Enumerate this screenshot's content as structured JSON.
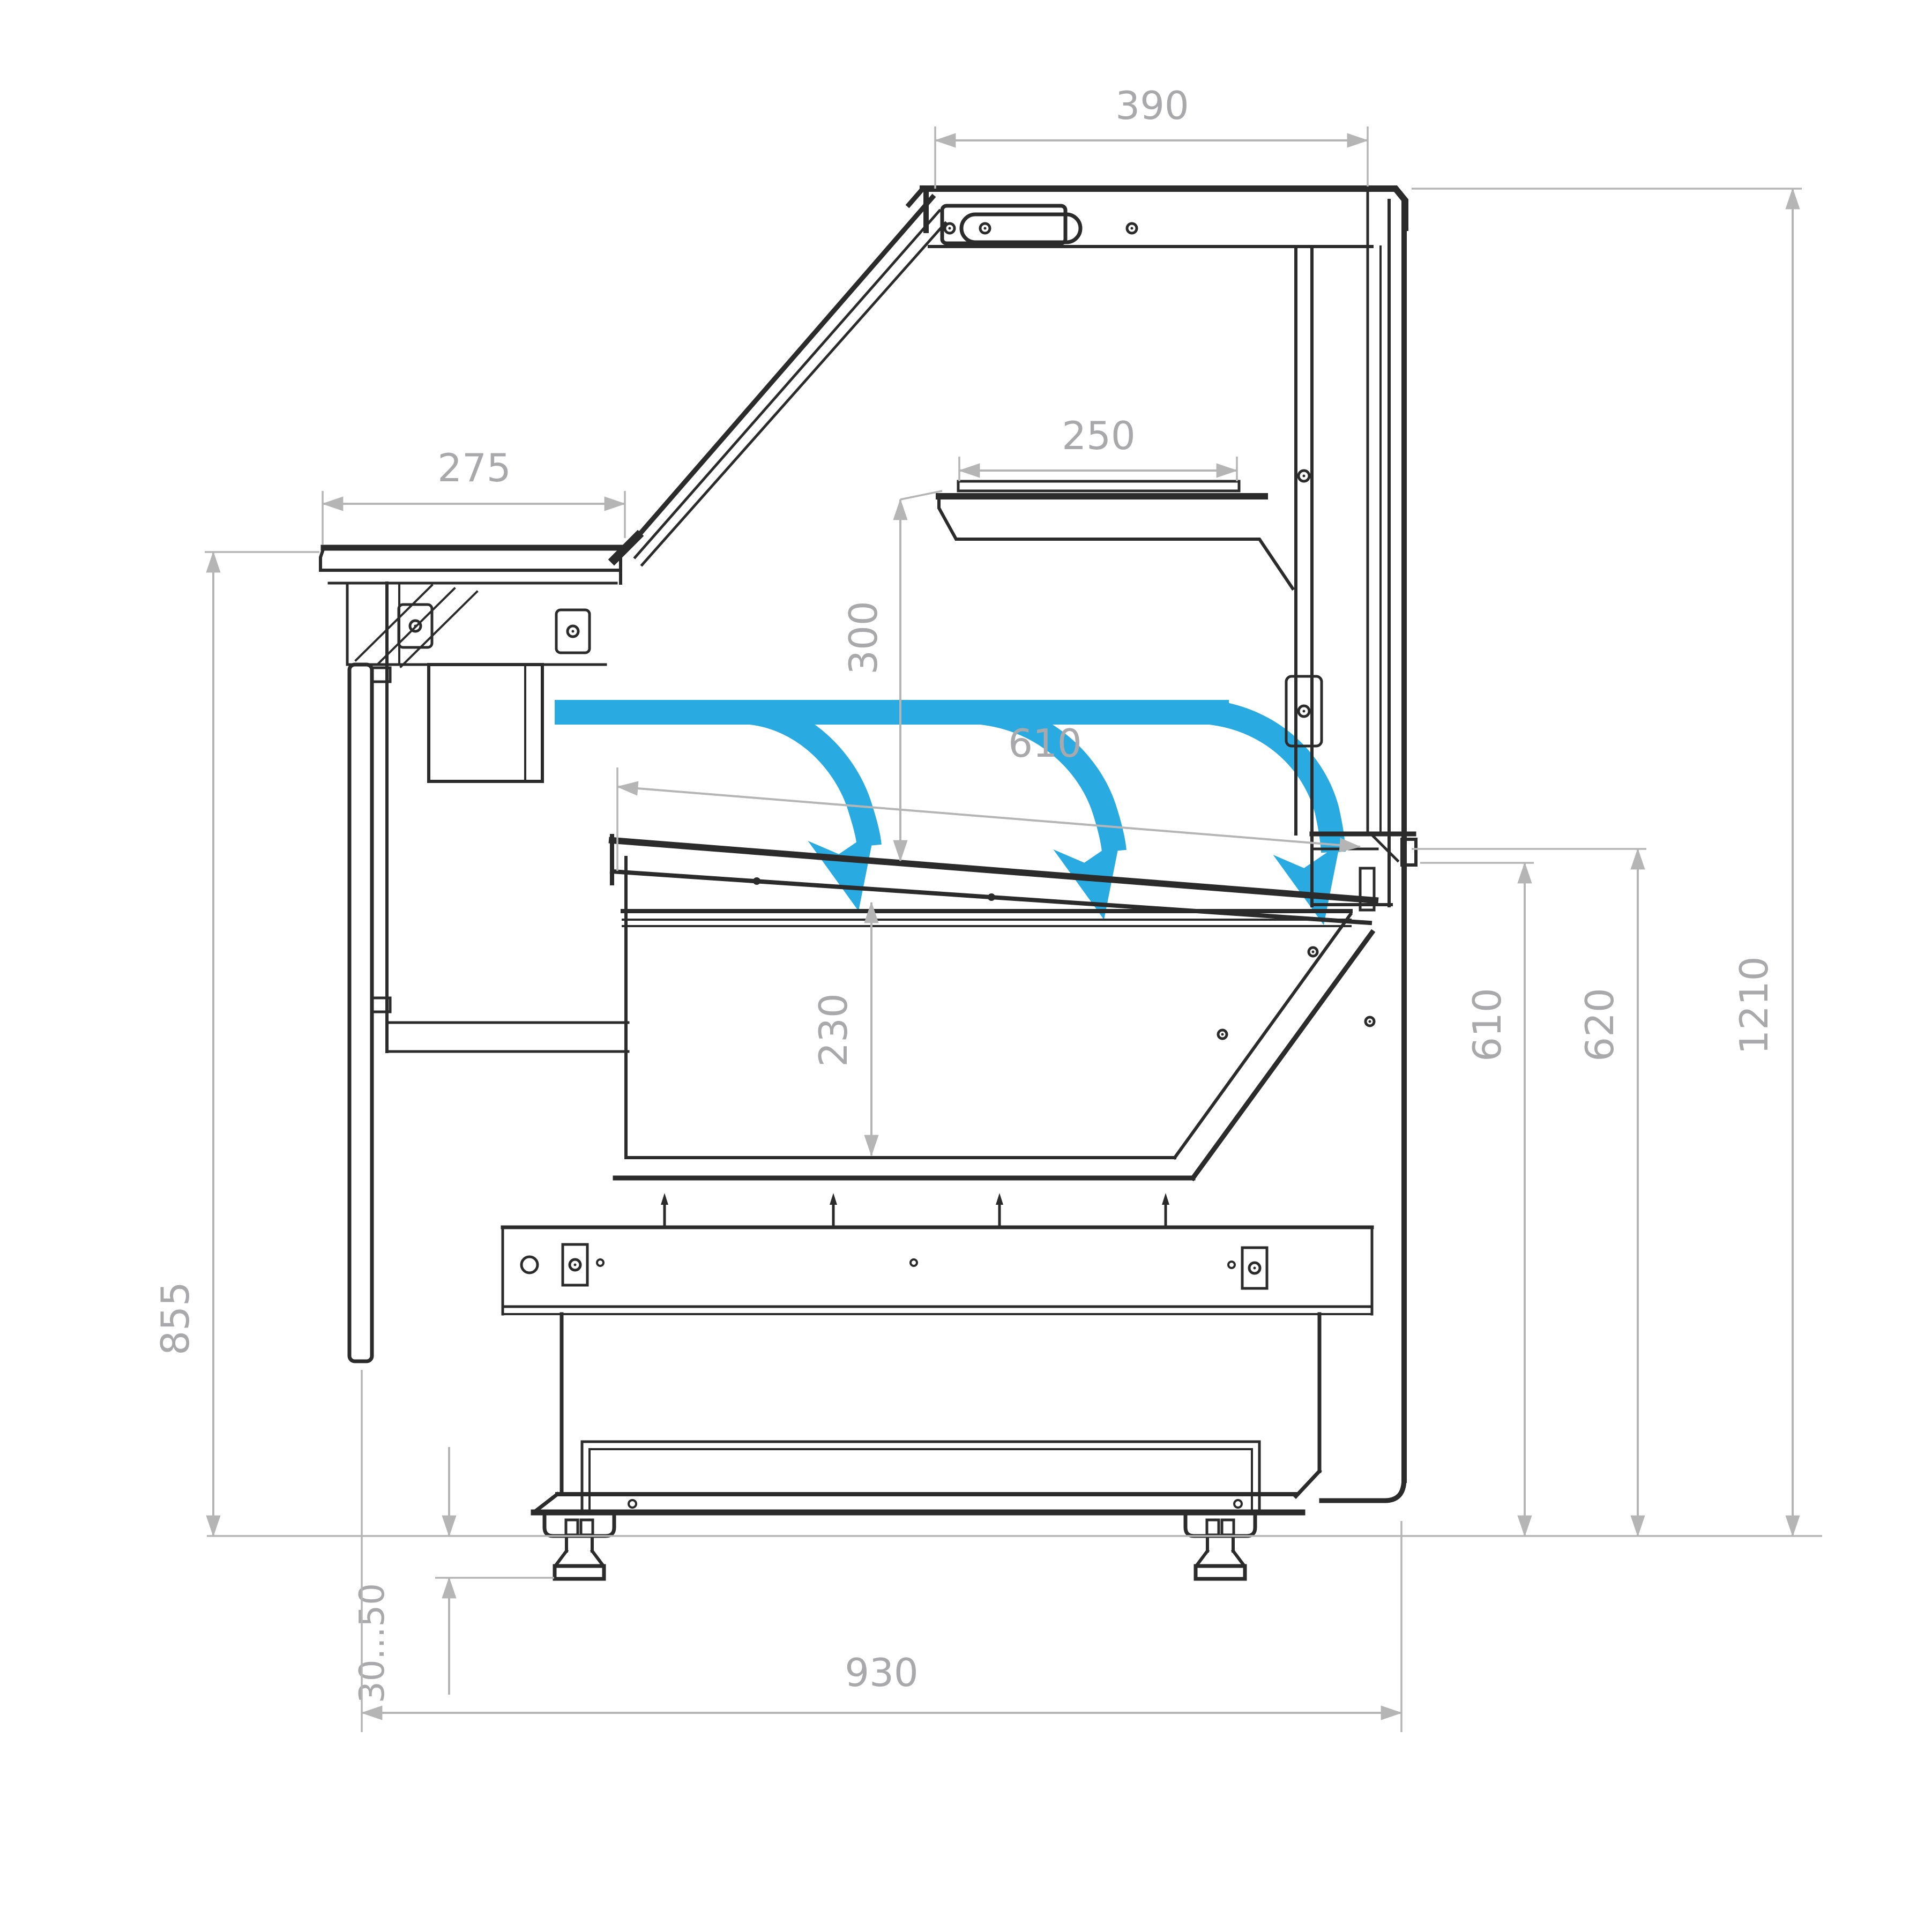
{
  "diagram": {
    "type": "technical-drawing",
    "subject": "refrigerated serve-over display counter, side cross-section with airflow",
    "units": "mm",
    "colors": {
      "outline": "#2b2b2b",
      "dimension_line": "#b5b5b5",
      "dimension_text": "#a9a9ab",
      "airflow": "#29abe2",
      "background": "#ffffff"
    },
    "airflow": {
      "icon": "cold-airflow-arrow-icon",
      "arrow_count": 3,
      "description": "air curtain blowing from rear duct down onto display tray"
    },
    "dimensions": {
      "canopy_depth": "390",
      "worktop_depth": "275",
      "shelf_depth": "250",
      "shelf_clearance": "300",
      "display_opening": "610",
      "well_depth": "230",
      "worktop_height": "855",
      "rear_deck_lower_height": "610",
      "rear_deck_height": "620",
      "overall_height": "1210",
      "foot_adjustment": "30...50",
      "overall_depth": "930"
    }
  }
}
